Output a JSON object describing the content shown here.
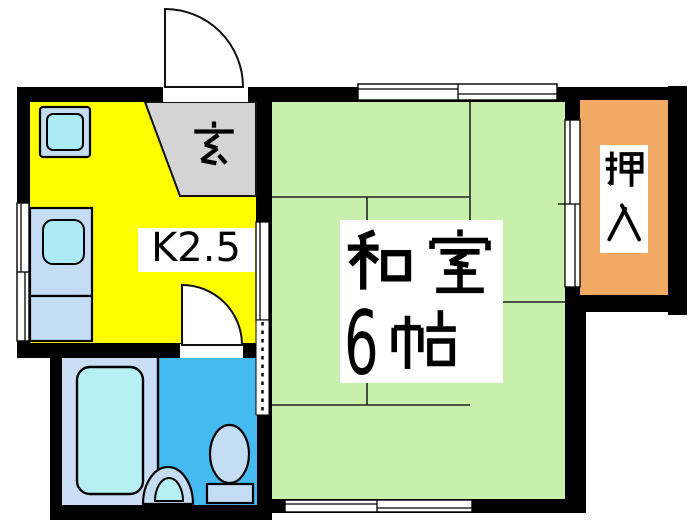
{
  "title": "Japanese apartment floor plan",
  "labels": {
    "kitchen": "K2.5",
    "genkan": "玄",
    "washitsu_line1": "和室",
    "washitsu_line2": "6帖",
    "washitsu_number": "6",
    "oshiire": "押入"
  },
  "rooms": [
    {
      "name": "kitchen",
      "label": "K2.5",
      "color": "#FFFF00"
    },
    {
      "name": "genkan-entrance",
      "label": "玄",
      "color": "#D4D4D4"
    },
    {
      "name": "washitsu-6-mat-room",
      "label": "和室 6帖",
      "color": "#C9EFAD"
    },
    {
      "name": "oshiire-closet",
      "label": "押入",
      "color": "#F2A964"
    },
    {
      "name": "bathroom",
      "color": "#CADEF5"
    },
    {
      "name": "toilet-washroom",
      "color": "#44BAF1"
    }
  ],
  "fixtures": [
    "stove",
    "kitchen-sink",
    "kitchen-counter",
    "bathtub",
    "washbasin",
    "toilet"
  ],
  "openings": [
    "entrance-swing-door",
    "washroom-swing-door",
    "sliding-door-kitchen-tatami",
    "open-doorway-dashed",
    "fusuma-tatami-closet",
    "window-left",
    "window-top",
    "window-bottom"
  ],
  "colors": {
    "wall": "#000000",
    "kitchen": "#FFFF00",
    "genkan": "#D4D4D4",
    "tatami": "#C9EFAD",
    "closet": "#F2A964",
    "bath_floor": "#CADEF5",
    "toilet_floor": "#44BAF1",
    "fixture_light": "#C4DDF4",
    "fixture_cyan": "#ABEBF6",
    "bathtub": "#B6EFF4"
  }
}
